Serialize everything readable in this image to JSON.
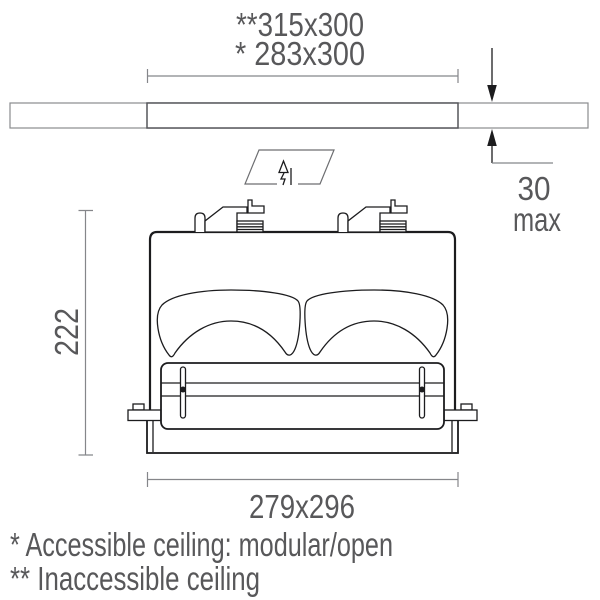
{
  "dimensions": {
    "cutout_inaccessible": "**315x300",
    "cutout_accessible": "* 283x300",
    "ceiling_thickness_value": "30",
    "ceiling_thickness_qualifier": "max",
    "fixture_height": "222",
    "fixture_footprint": "279x296"
  },
  "footnotes": {
    "accessible": "* Accessible ceiling: modular/open",
    "inaccessible": "** Inaccessible ceiling"
  },
  "icons": {
    "insertion_arrow": "insertion-arrow-icon"
  },
  "colors": {
    "line_black": "#1c1c1e",
    "dimension_gray": "#85868a",
    "text_gray": "#58585a",
    "ceiling_gray": "#8a8b8e",
    "background": "#ffffff"
  }
}
